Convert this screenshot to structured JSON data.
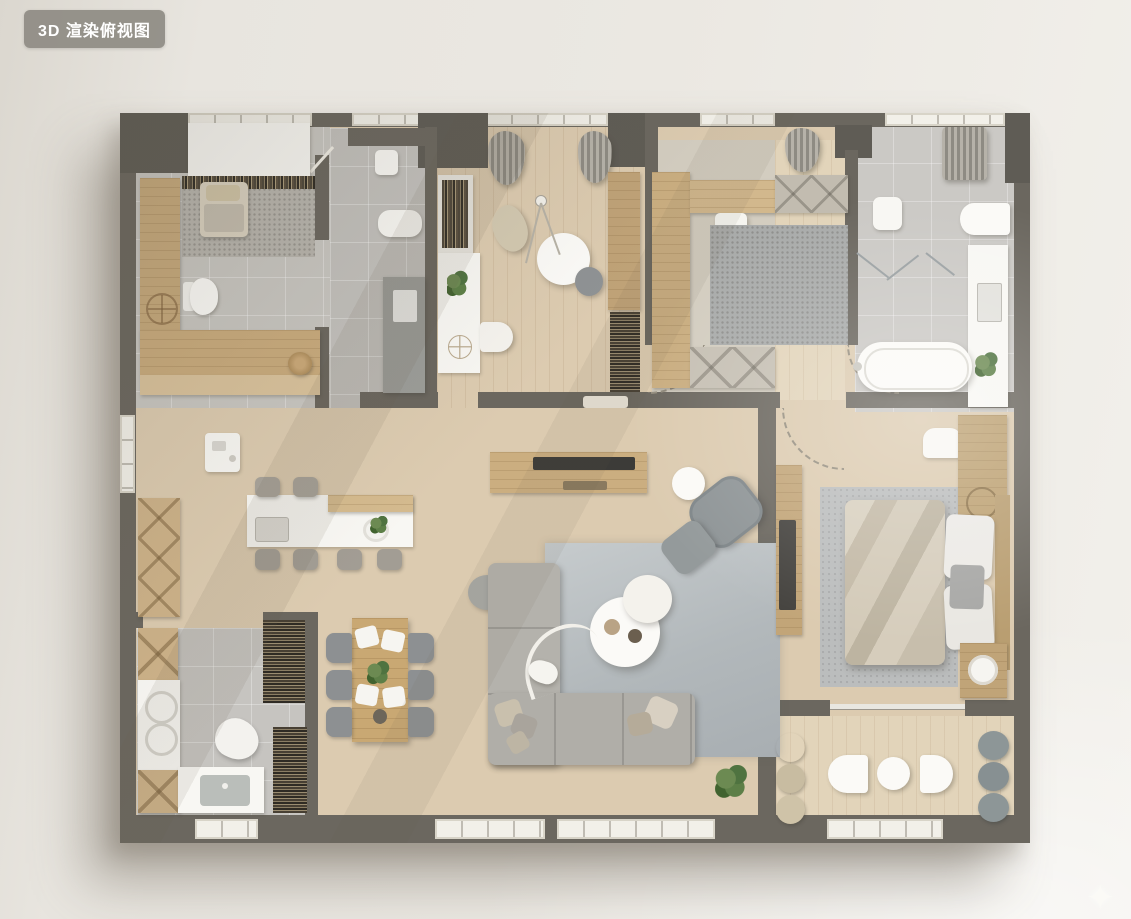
{
  "viewer": {
    "badge_label": "3D 渲染俯视图",
    "watermark_glyph": "✦"
  },
  "palette": {
    "background": "#e8e5df",
    "wall": "#6b675f",
    "wood_floor": "#dccbb0",
    "tile_floor": "#c8c6c1",
    "rug_gray": "#b2b8bb",
    "furniture_white": "#f8f7f3",
    "furniture_wood": "#c6a97c",
    "badge_bg": "#8e8b83",
    "plant_green": "#5d7f47"
  },
  "scene": {
    "type": "3d-rendered-floorplan-top-view",
    "rooms": [
      {
        "name": "multifunction-room-top-left",
        "furniture": [
          "white-wardrobe",
          "book-shelf",
          "daybed-with-pillow",
          "l-shaped-wood-counter",
          "toilet",
          "wood-stool"
        ]
      },
      {
        "name": "entry-hall",
        "furniture": [
          "door-mat",
          "shoe-bench",
          "storage-cabinet",
          "entry-door"
        ]
      },
      {
        "name": "study",
        "furniture": [
          "curtains",
          "desk-with-shelf",
          "desk-chair",
          "round-table",
          "floor-lamp",
          "lounge-pouf",
          "side-chair",
          "wood-cabinet-with-books"
        ]
      },
      {
        "name": "home-office",
        "furniture": [
          "wood-desk-panel",
          "desk-chair",
          "area-rug",
          "upper-cabinets",
          "lower-cabinets",
          "curtain"
        ]
      },
      {
        "name": "bathroom",
        "furniture": [
          "shower-curtain",
          "glass-partition",
          "toilet",
          "vanity-with-sink",
          "bathtub",
          "bath-mat",
          "plant"
        ]
      },
      {
        "name": "kitchen",
        "furniture": [
          "coffee-machine",
          "island-with-sink",
          "bar-stools",
          "wall-cabinets"
        ]
      },
      {
        "name": "dining-area",
        "furniture": [
          "dining-table",
          "six-chairs",
          "plates",
          "centerpiece-plant"
        ]
      },
      {
        "name": "laundry-bathroom",
        "furniture": [
          "wood-cabinets",
          "twin-basin-counter",
          "sink-counter",
          "storage-shelf",
          "bookcase",
          "cleaning-robot"
        ]
      },
      {
        "name": "living-room",
        "furniture": [
          "tv-console",
          "tv",
          "sectional-sofa",
          "pillows",
          "round-coffee-tables",
          "armchair",
          "ottoman",
          "side-table",
          "arc-floor-lamp",
          "rug",
          "plant",
          "bench"
        ]
      },
      {
        "name": "master-bedroom",
        "furniture": [
          "double-bed",
          "pillows",
          "headboard-panel",
          "nightstand-with-tray",
          "rug",
          "tv-panel",
          "wardrobe-cabinet",
          "wash-basin"
        ]
      },
      {
        "name": "balcony-lounge",
        "furniture": [
          "rattan-poufs",
          "gray-poufs",
          "white-seats",
          "round-table"
        ]
      }
    ]
  }
}
